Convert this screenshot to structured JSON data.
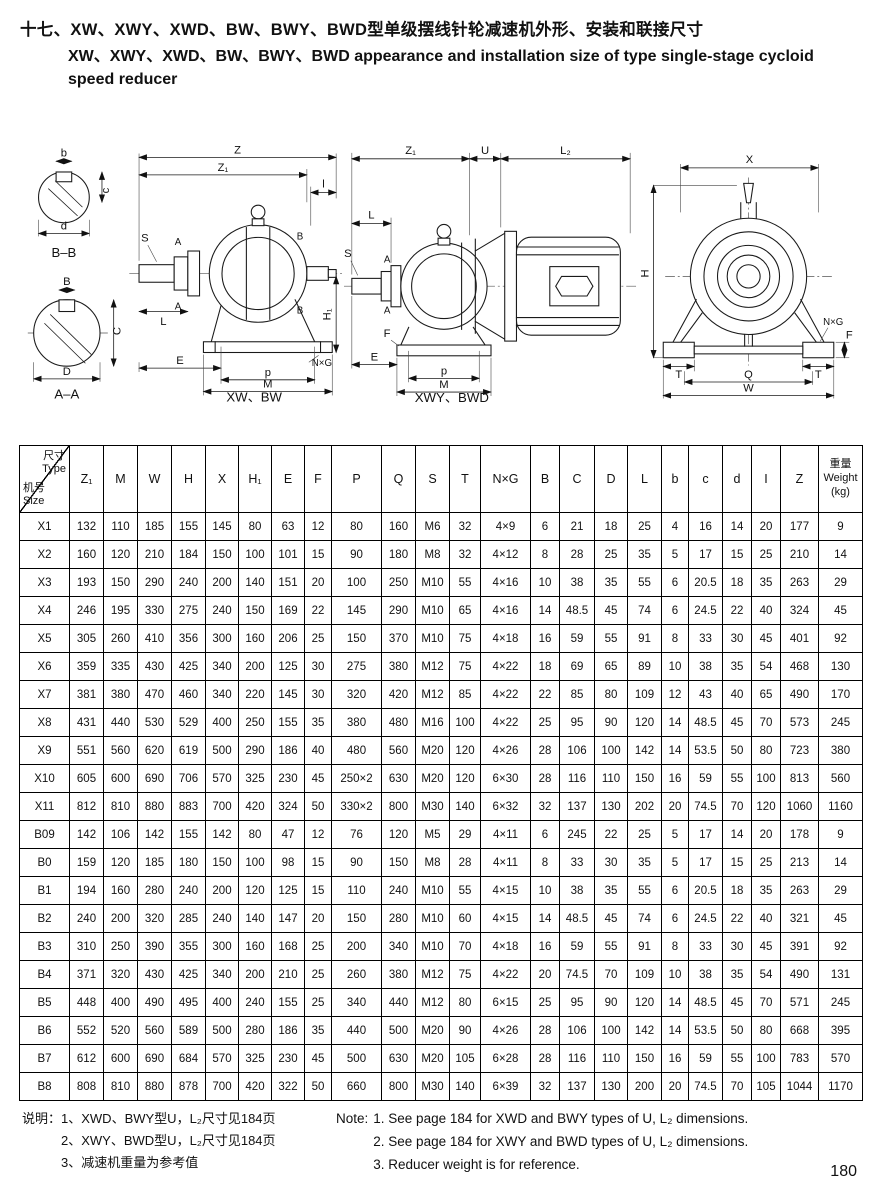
{
  "header": {
    "title_zh": "十七、XW、XWY、XWD、BW、BWY、BWD型单级摆线针轮减速机外形、安装和联接尺寸",
    "title_en1": "XW、XWY、XWD、BW、BWY、BWD appearance and installation size of type single-stage cycloid",
    "title_en2": "speed reducer"
  },
  "diagrams": {
    "caption_xw_bw": "XW、BW",
    "caption_xwy_bwd": "XWY、BWD",
    "sections": {
      "b": "b",
      "c": "c",
      "d": "d",
      "bb": "B–B",
      "B": "B",
      "C": "C",
      "D": "D",
      "aa": "A–A"
    },
    "side": {
      "Z": "Z",
      "Z1": "Z₁",
      "l": "l",
      "S": "S",
      "A": "A",
      "B": "B",
      "L": "L",
      "E": "E",
      "p": "p",
      "M": "M",
      "NxG": "N×G",
      "H1": "H₁"
    },
    "combo": {
      "Z1": "Z₁",
      "U": "U",
      "L2": "L₂",
      "L": "L",
      "S": "S",
      "A": "A",
      "F": "F",
      "E": "E",
      "p": "p",
      "M": "M"
    },
    "front": {
      "X": "X",
      "H": "H",
      "NxG": "N×G",
      "F": "F",
      "T": "T",
      "Q": "Q",
      "W": "W"
    }
  },
  "table": {
    "corner_top_zh": "尺寸",
    "corner_top_en": "Type",
    "corner_bottom_zh": "机号",
    "corner_bottom_en": "Size",
    "columns": [
      "Z₁",
      "M",
      "W",
      "H",
      "X",
      "H₁",
      "E",
      "F",
      "P",
      "Q",
      "S",
      "T",
      "N×G",
      "B",
      "C",
      "D",
      "L",
      "b",
      "c",
      "d",
      "I",
      "Z"
    ],
    "weight_zh": "重量",
    "weight_en": "Weight",
    "weight_unit": "(kg)",
    "rows": [
      {
        "size": "X1",
        "values": [
          "132",
          "110",
          "185",
          "155",
          "145",
          "80",
          "63",
          "12",
          "80",
          "160",
          "M6",
          "32",
          "4×9",
          "6",
          "21",
          "18",
          "25",
          "4",
          "16",
          "14",
          "20",
          "177",
          "9"
        ]
      },
      {
        "size": "X2",
        "values": [
          "160",
          "120",
          "210",
          "184",
          "150",
          "100",
          "101",
          "15",
          "90",
          "180",
          "M8",
          "32",
          "4×12",
          "8",
          "28",
          "25",
          "35",
          "5",
          "17",
          "15",
          "25",
          "210",
          "14"
        ]
      },
      {
        "size": "X3",
        "values": [
          "193",
          "150",
          "290",
          "240",
          "200",
          "140",
          "151",
          "20",
          "100",
          "250",
          "M10",
          "55",
          "4×16",
          "10",
          "38",
          "35",
          "55",
          "6",
          "20.5",
          "18",
          "35",
          "263",
          "29"
        ]
      },
      {
        "size": "X4",
        "values": [
          "246",
          "195",
          "330",
          "275",
          "240",
          "150",
          "169",
          "22",
          "145",
          "290",
          "M10",
          "65",
          "4×16",
          "14",
          "48.5",
          "45",
          "74",
          "6",
          "24.5",
          "22",
          "40",
          "324",
          "45"
        ]
      },
      {
        "size": "X5",
        "values": [
          "305",
          "260",
          "410",
          "356",
          "300",
          "160",
          "206",
          "25",
          "150",
          "370",
          "M10",
          "75",
          "4×18",
          "16",
          "59",
          "55",
          "91",
          "8",
          "33",
          "30",
          "45",
          "401",
          "92"
        ]
      },
      {
        "size": "X6",
        "values": [
          "359",
          "335",
          "430",
          "425",
          "340",
          "200",
          "125",
          "30",
          "275",
          "380",
          "M12",
          "75",
          "4×22",
          "18",
          "69",
          "65",
          "89",
          "10",
          "38",
          "35",
          "54",
          "468",
          "130"
        ]
      },
      {
        "size": "X7",
        "values": [
          "381",
          "380",
          "470",
          "460",
          "340",
          "220",
          "145",
          "30",
          "320",
          "420",
          "M12",
          "85",
          "4×22",
          "22",
          "85",
          "80",
          "109",
          "12",
          "43",
          "40",
          "65",
          "490",
          "170"
        ]
      },
      {
        "size": "X8",
        "values": [
          "431",
          "440",
          "530",
          "529",
          "400",
          "250",
          "155",
          "35",
          "380",
          "480",
          "M16",
          "100",
          "4×22",
          "25",
          "95",
          "90",
          "120",
          "14",
          "48.5",
          "45",
          "70",
          "573",
          "245"
        ]
      },
      {
        "size": "X9",
        "values": [
          "551",
          "560",
          "620",
          "619",
          "500",
          "290",
          "186",
          "40",
          "480",
          "560",
          "M20",
          "120",
          "4×26",
          "28",
          "106",
          "100",
          "142",
          "14",
          "53.5",
          "50",
          "80",
          "723",
          "380"
        ]
      },
      {
        "size": "X10",
        "values": [
          "605",
          "600",
          "690",
          "706",
          "570",
          "325",
          "230",
          "45",
          "250×2",
          "630",
          "M20",
          "120",
          "6×30",
          "28",
          "116",
          "110",
          "150",
          "16",
          "59",
          "55",
          "100",
          "813",
          "560"
        ]
      },
      {
        "size": "X11",
        "values": [
          "812",
          "810",
          "880",
          "883",
          "700",
          "420",
          "324",
          "50",
          "330×2",
          "800",
          "M30",
          "140",
          "6×32",
          "32",
          "137",
          "130",
          "202",
          "20",
          "74.5",
          "70",
          "120",
          "1060",
          "1160"
        ]
      },
      {
        "size": "B09",
        "values": [
          "142",
          "106",
          "142",
          "155",
          "142",
          "80",
          "47",
          "12",
          "76",
          "120",
          "M5",
          "29",
          "4×11",
          "6",
          "245",
          "22",
          "25",
          "5",
          "17",
          "14",
          "20",
          "178",
          "9"
        ]
      },
      {
        "size": "B0",
        "values": [
          "159",
          "120",
          "185",
          "180",
          "150",
          "100",
          "98",
          "15",
          "90",
          "150",
          "M8",
          "28",
          "4×11",
          "8",
          "33",
          "30",
          "35",
          "5",
          "17",
          "15",
          "25",
          "213",
          "14"
        ]
      },
      {
        "size": "B1",
        "values": [
          "194",
          "160",
          "280",
          "240",
          "200",
          "120",
          "125",
          "15",
          "110",
          "240",
          "M10",
          "55",
          "4×15",
          "10",
          "38",
          "35",
          "55",
          "6",
          "20.5",
          "18",
          "35",
          "263",
          "29"
        ]
      },
      {
        "size": "B2",
        "values": [
          "240",
          "200",
          "320",
          "285",
          "240",
          "140",
          "147",
          "20",
          "150",
          "280",
          "M10",
          "60",
          "4×15",
          "14",
          "48.5",
          "45",
          "74",
          "6",
          "24.5",
          "22",
          "40",
          "321",
          "45"
        ]
      },
      {
        "size": "B3",
        "values": [
          "310",
          "250",
          "390",
          "355",
          "300",
          "160",
          "168",
          "25",
          "200",
          "340",
          "M10",
          "70",
          "4×18",
          "16",
          "59",
          "55",
          "91",
          "8",
          "33",
          "30",
          "45",
          "391",
          "92"
        ]
      },
      {
        "size": "B4",
        "values": [
          "371",
          "320",
          "430",
          "425",
          "340",
          "200",
          "210",
          "25",
          "260",
          "380",
          "M12",
          "75",
          "4×22",
          "20",
          "74.5",
          "70",
          "109",
          "10",
          "38",
          "35",
          "54",
          "490",
          "131"
        ]
      },
      {
        "size": "B5",
        "values": [
          "448",
          "400",
          "490",
          "495",
          "400",
          "240",
          "155",
          "25",
          "340",
          "440",
          "M12",
          "80",
          "6×15",
          "25",
          "95",
          "90",
          "120",
          "14",
          "48.5",
          "45",
          "70",
          "571",
          "245"
        ]
      },
      {
        "size": "B6",
        "values": [
          "552",
          "520",
          "560",
          "589",
          "500",
          "280",
          "186",
          "35",
          "440",
          "500",
          "M20",
          "90",
          "4×26",
          "28",
          "106",
          "100",
          "142",
          "14",
          "53.5",
          "50",
          "80",
          "668",
          "395"
        ]
      },
      {
        "size": "B7",
        "values": [
          "612",
          "600",
          "690",
          "684",
          "570",
          "325",
          "230",
          "45",
          "500",
          "630",
          "M20",
          "105",
          "6×28",
          "28",
          "116",
          "110",
          "150",
          "16",
          "59",
          "55",
          "100",
          "783",
          "570"
        ]
      },
      {
        "size": "B8",
        "values": [
          "808",
          "810",
          "880",
          "878",
          "700",
          "420",
          "322",
          "50",
          "660",
          "800",
          "M30",
          "140",
          "6×39",
          "32",
          "137",
          "130",
          "200",
          "20",
          "74.5",
          "70",
          "105",
          "1044",
          "1170"
        ]
      }
    ]
  },
  "notes": {
    "zh_label": "说明：",
    "zh": [
      "1、XWD、BWY型U，L₂尺寸见184页",
      "2、XWY、BWD型U，L₂尺寸见184页",
      "3、减速机重量为参考值"
    ],
    "en_label": "Note:",
    "en": [
      "1. See page 184 for XWD and BWY types of U, L₂ dimensions.",
      "2. See page 184 for XWY and BWD types of U, L₂ dimensions.",
      "3. Reducer weight is for reference."
    ]
  },
  "footer": {
    "page_number": "180"
  }
}
